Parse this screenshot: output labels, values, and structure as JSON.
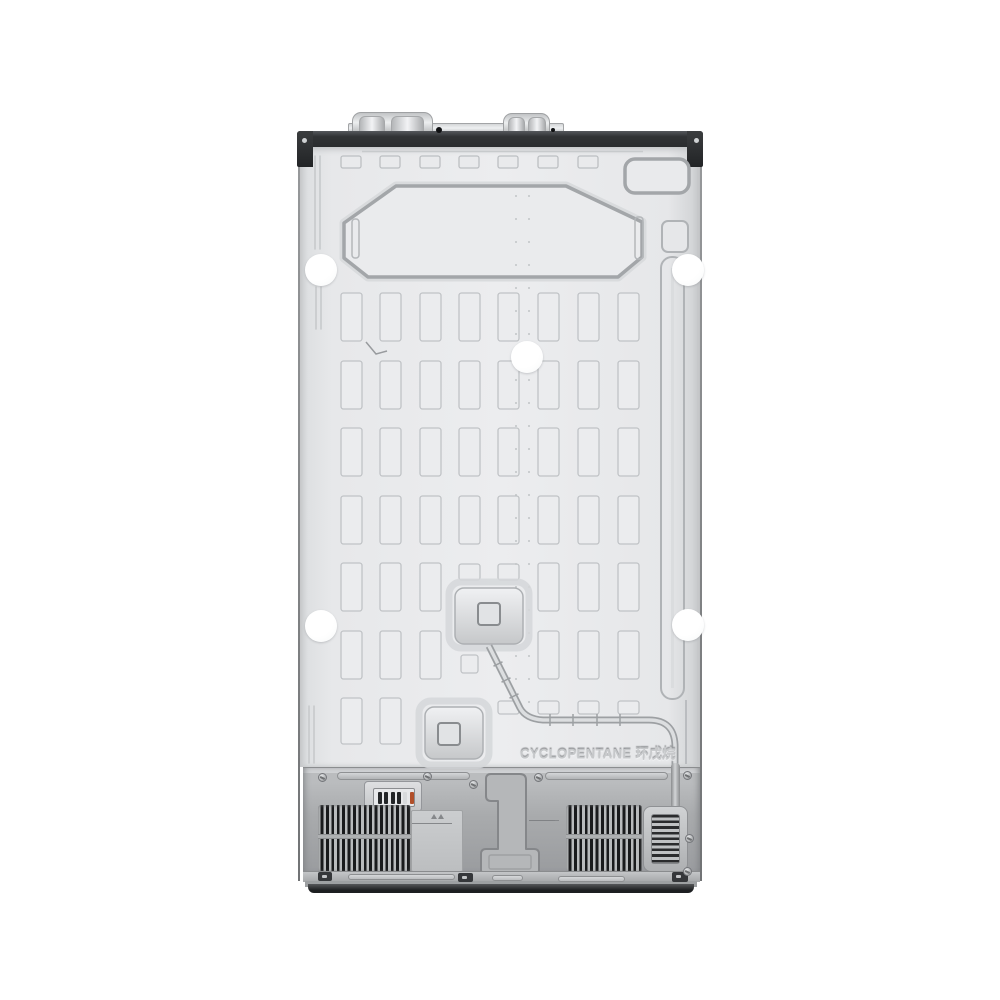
{
  "scene": {
    "type": "product-photo",
    "subject": "refrigerator back panel, rear view",
    "background": "#ffffff"
  },
  "text": {
    "refrigerant_emboss": "CYCLOPENTANE 环戊烷"
  },
  "palette": {
    "panel_light": "#ecedef",
    "panel_mid": "#dfe1e3",
    "groove": "#a5a8ab",
    "cell_fill": "#ebecee",
    "cell_stroke": "#c0c3c6",
    "band_dark": "#2d2f31",
    "compartment_gray": "#a9abad",
    "vent_slot_dark": "#191a1c",
    "vent_fin": "#b9bbbd",
    "plinth_dark": "#1d1f21",
    "sticker_white": "#ffffff",
    "pin_orange": "#b14f2a"
  },
  "grid": {
    "columns_x": [
      341,
      380,
      420,
      459,
      498,
      538,
      578,
      618
    ],
    "rows_y": [
      293,
      361,
      428,
      496,
      563,
      631,
      698
    ],
    "cell_w": 21,
    "cell_h": 48,
    "last_row_h": 46,
    "skip_cells": [
      [
        4,
        3
      ],
      [
        4,
        4
      ],
      [
        5,
        3
      ],
      [
        5,
        4
      ],
      [
        6,
        2
      ],
      [
        6,
        3
      ],
      [
        6,
        4
      ],
      [
        6,
        5
      ],
      [
        6,
        6
      ],
      [
        6,
        7
      ]
    ],
    "stub_cells": [
      [
        459,
        564,
        21,
        16
      ],
      [
        498,
        564,
        21,
        16
      ],
      [
        461,
        655,
        17,
        18
      ],
      [
        498,
        701,
        21,
        13
      ],
      [
        538,
        701,
        21,
        13
      ],
      [
        578,
        701,
        21,
        13
      ],
      [
        618,
        701,
        21,
        13
      ]
    ],
    "top_row": {
      "y": 156,
      "w": 20,
      "h": 12,
      "count": 7
    }
  },
  "weld_dots": {
    "columns_x": [
      516,
      529
    ],
    "y_start": 196,
    "y_end": 704,
    "step": 23,
    "r": 1
  },
  "stickers": [
    [
      321,
      270
    ],
    [
      688,
      270
    ],
    [
      527,
      357
    ],
    [
      321,
      626
    ],
    [
      688,
      625
    ]
  ],
  "screws": [
    [
      322,
      777
    ],
    [
      427,
      776
    ],
    [
      473,
      784
    ],
    [
      538,
      777
    ],
    [
      687,
      775
    ],
    [
      689,
      838
    ],
    [
      687,
      871
    ]
  ],
  "terminal_pins": [
    "#232527",
    "#232527",
    "#232527",
    "#232527",
    "#d8dadc",
    "#b14f2a"
  ],
  "rating_label_lines": [
    14,
    0,
    26,
    0,
    30,
    40,
    36,
    0,
    34,
    40,
    30,
    0,
    32,
    38,
    36,
    0,
    28,
    40,
    34
  ],
  "mini_text_lines": [
    14,
    24,
    30,
    26
  ]
}
